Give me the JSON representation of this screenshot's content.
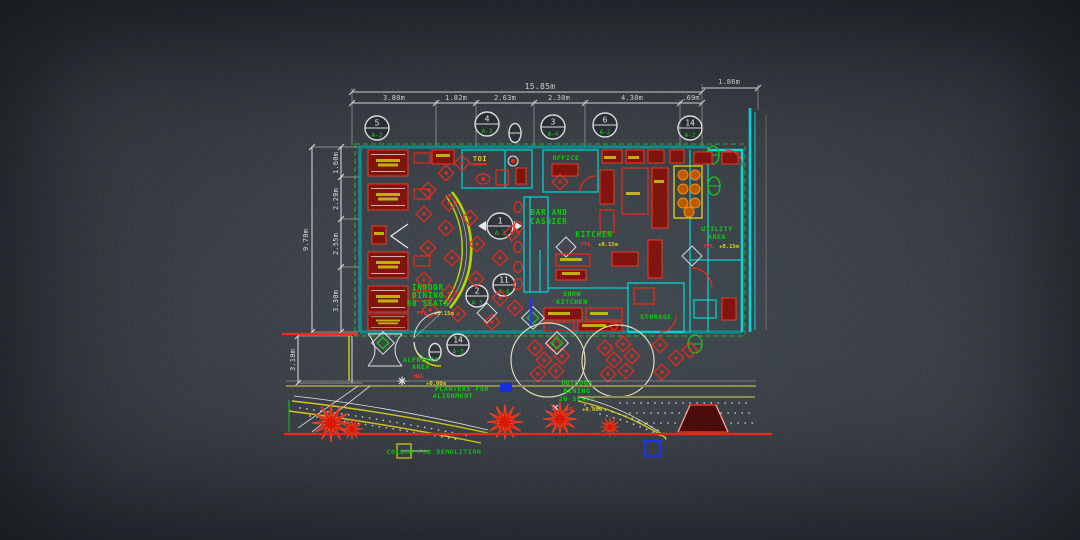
{
  "drawing": {
    "dims": {
      "top_total": "15.85m",
      "top_segments": [
        "3.80m",
        "1.82m",
        "2.63m",
        "2.30m",
        "4.30m",
        ".69m"
      ],
      "top_right": "1.86m",
      "left_total": "9.70m",
      "left_segments": [
        "1.60m",
        "2.20m",
        "2.55m",
        "3.30m"
      ],
      "left_lower": "3.10m"
    },
    "bubbles": [
      {
        "num": "5",
        "code": "A-3"
      },
      {
        "num": "4",
        "code": "A-3"
      },
      {
        "num": "3",
        "code": "A-4"
      },
      {
        "num": "6",
        "code": "A-2"
      },
      {
        "num": "14",
        "code": "A-2"
      },
      {
        "num": "1",
        "code": "A-3"
      },
      {
        "num": "2",
        "code": "A-3"
      },
      {
        "num": "11",
        "code": "A-4"
      },
      {
        "num": "14",
        "code": "A-3"
      }
    ],
    "rooms": {
      "toi": "TOI",
      "office": "OFFICE",
      "bar": [
        "BAR AND",
        "CASHIER"
      ],
      "kitchen": "KITCHEN",
      "utility": [
        "UTILITY",
        "AREA"
      ],
      "show_kitchen": [
        "SHOW",
        "KITCHEN"
      ],
      "storage": "STORAGE",
      "indoor": [
        "INDOOR",
        "DINING",
        "60 SEATS"
      ],
      "alfresco": [
        "ALFRESCO",
        "AREA"
      ],
      "outdoor": [
        "OUTDOOR",
        "DINING",
        "20 SEATS"
      ]
    },
    "levels": {
      "ffl": "FFL",
      "ffl_val": "+0.15m",
      "ngl": "NGL",
      "ngl_val": "+0.00m"
    },
    "notes": {
      "planters_1": "PLANTERS FOR",
      "planters_2": "ALIGNMENT",
      "column": "COLUMN FOR DEMOLITION"
    },
    "colors": {
      "wall": "#00d9d9",
      "furniture": "#e82a1c",
      "label": "#0bd40b",
      "dimension": "#e2e2e2",
      "accent": "#d9cb22",
      "road": "#ff2a20",
      "marker_blue": "#2438e8"
    }
  }
}
